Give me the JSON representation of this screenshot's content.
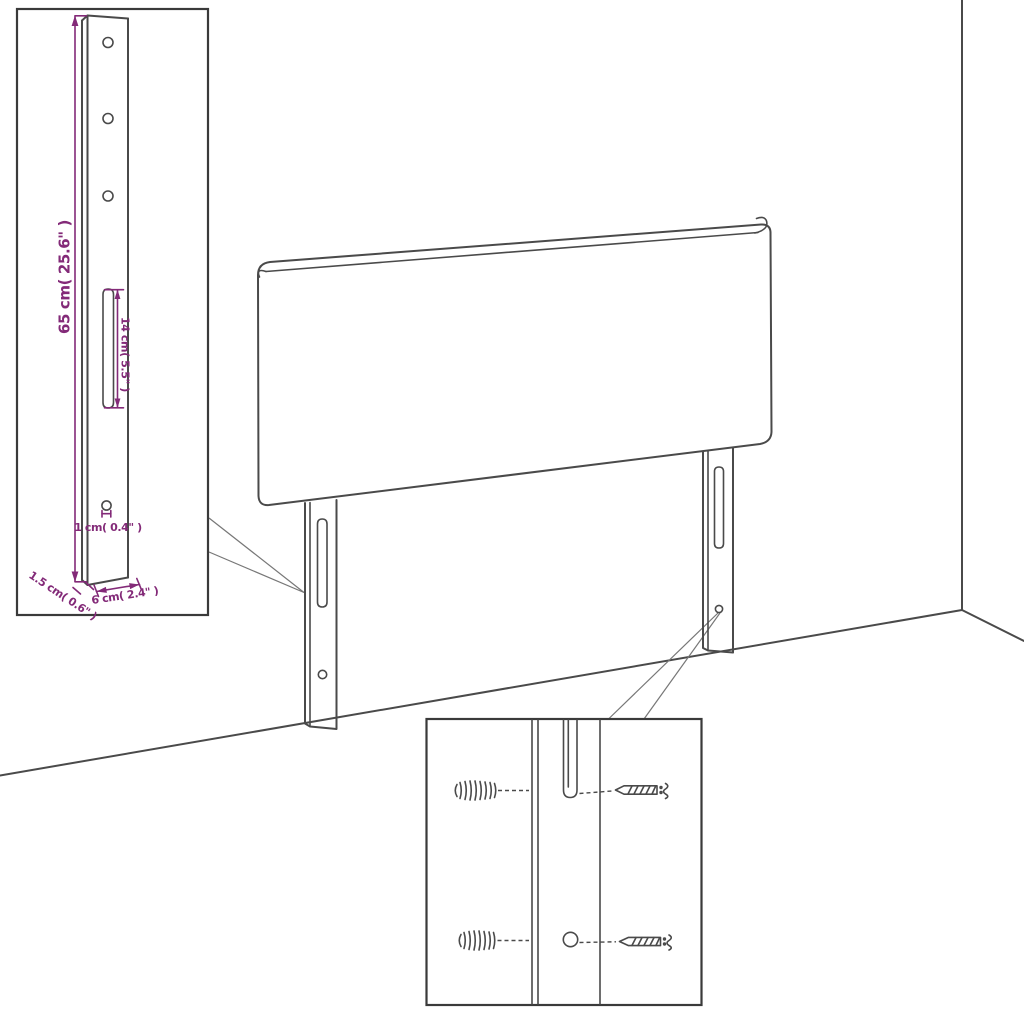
{
  "colors": {
    "background": "#ffffff",
    "line": "#4a4a4a",
    "box": "#3a3a3a",
    "leader": "#777777",
    "dimension": "#832a78"
  },
  "diagram": {
    "subject": "headboard-with-mounting-legs",
    "dimensions": {
      "height": "65 cm( 25.6\" )",
      "slot_length": "14 cm( 5.5\" )",
      "hole_diameter": "1 cm( 0.4\" )",
      "thickness": "1.5 cm( 0.6\" )",
      "width": "6 cm( 2.4\" )"
    }
  }
}
